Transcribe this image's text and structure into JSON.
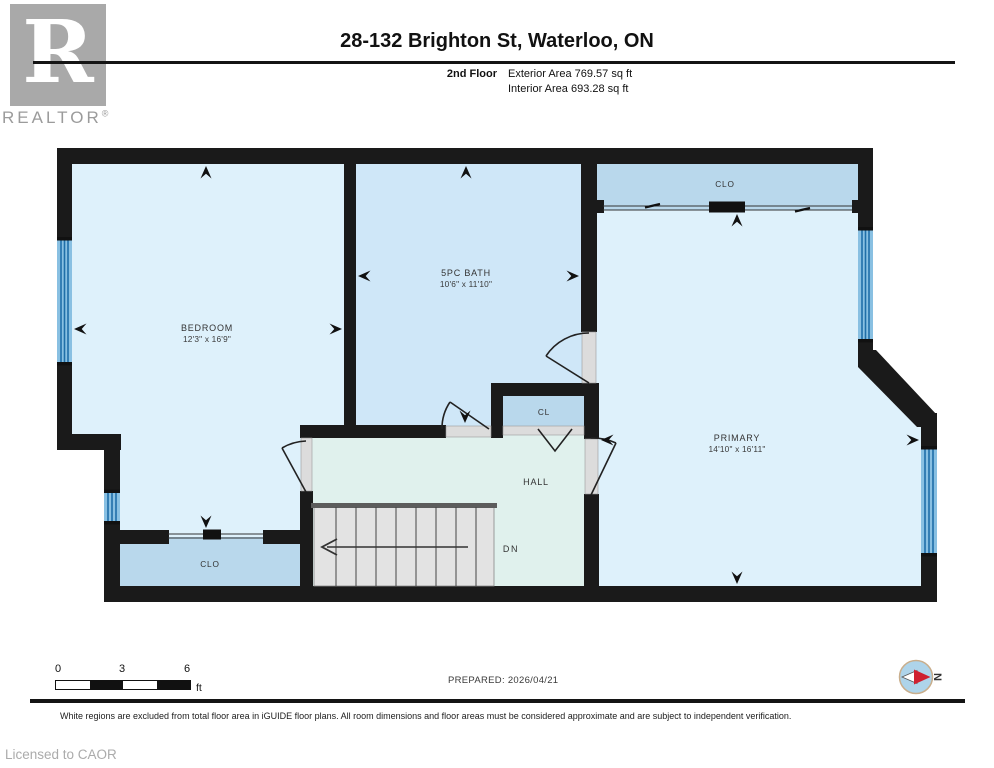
{
  "header": {
    "logo_letter": "R",
    "logo_brand": "REALTOR",
    "logo_reg": "®",
    "title": "28-132 Brighton St, Waterloo, ON",
    "floor_label": "2nd Floor",
    "exterior_area": "Exterior Area 769.57 sq ft",
    "interior_area": "Interior Area 693.28 sq ft"
  },
  "plan": {
    "rooms": {
      "bedroom": {
        "name": "BEDROOM",
        "dims": "12'3\" x 16'9\""
      },
      "bath": {
        "name": "5PC BATH",
        "dims": "10'6\" x 11'10\""
      },
      "primary": {
        "name": "PRIMARY",
        "dims": "14'10\" x 16'11\""
      },
      "hall": {
        "name": "HALL"
      },
      "closet_top_right": {
        "name": "CLO"
      },
      "closet_hall": {
        "name": "CL"
      },
      "closet_bedroom": {
        "name": "CLO"
      },
      "stairs_label": "DN"
    },
    "colors": {
      "wall": "#1a1a1a",
      "room_light_blue": "#def1fb",
      "bath_blue": "#cfe7f8",
      "closet_blue": "#b9d8ec",
      "hall_mint": "#e0f1ed",
      "window_blue": "#89c0e2",
      "window_stripe": "#1f6ea8",
      "stairs_gray": "#e3e3e3",
      "compass_red": "#cf2030"
    }
  },
  "footer": {
    "scale": {
      "tick0": "0",
      "tick1": "3",
      "tick2": "6",
      "unit": "ft"
    },
    "prepared": "PREPARED: 2026/04/21",
    "compass_n": "N",
    "disclaimer": "White regions are excluded from total floor area in iGUIDE floor plans. All room dimensions and floor areas must be considered approximate and are subject to independent verification.",
    "license": "Licensed to CAOR"
  }
}
